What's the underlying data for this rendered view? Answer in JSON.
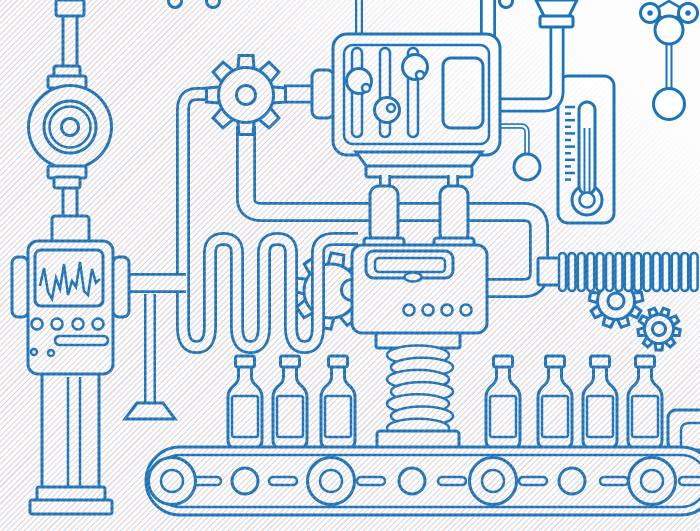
{
  "scene": {
    "width": 700,
    "height": 531,
    "description": "blue outline factory machine illustration"
  },
  "palette": {
    "stroke": "#1a74ba",
    "fill": "#ffffff",
    "hatch_warm": "rgba(198,141,141,0.40)",
    "hatch_cool": "rgba(141,160,198,0.38)"
  },
  "serpentine": {
    "start": "M246,94 H197 Q183,94 183,110 V327",
    "verticals": [
      183,
      210,
      237,
      264,
      291,
      318
    ],
    "bottom_y": 347,
    "top_y": 239,
    "v_top": 253,
    "v_bottom": 327,
    "end": "V253 Q318,239 334,239 H358",
    "width": 14,
    "inner_width": 8.5
  },
  "gears": [
    {
      "slot": "slot-gear-mid",
      "name": "gear-middle-icon",
      "cx": 331,
      "cy": 291,
      "body_r": 27,
      "hub_r": 0,
      "teeth": 8,
      "tooth_inner": 21,
      "tooth_outer": 37.5,
      "tooth_halfw": 8,
      "angle": -80
    },
    {
      "slot": "slot-gear-large",
      "name": "gear-large-icon",
      "cx": 246,
      "cy": 95,
      "body_r": 27.5,
      "hub_r": 9.5,
      "teeth": 8,
      "tooth_inner": 21,
      "tooth_outer": 39.5,
      "tooth_halfw": 8.5,
      "angle": -90
    },
    {
      "slot": "slot-gear-right1",
      "name": "gear-small-left-icon",
      "cx": 616,
      "cy": 301,
      "body_r": 18.5,
      "hub_r": 8,
      "teeth": 9,
      "tooth_inner": 13,
      "tooth_outer": 26.5,
      "tooth_halfw": 5.5,
      "angle": -90
    },
    {
      "slot": "slot-gear-right2",
      "name": "gear-small-right-icon",
      "cx": 659,
      "cy": 329,
      "body_r": 14.5,
      "hub_r": 6.5,
      "teeth": 9,
      "tooth_inner": 10,
      "tooth_outer": 21,
      "tooth_halfw": 4.5,
      "angle": -70
    }
  ],
  "hose": {
    "x0": 559,
    "step": 9.4,
    "count": 15,
    "y": 253,
    "rib_w": 7,
    "rib_h": 38,
    "rib_r": 3.5
  },
  "spring": {
    "cx_even": 418,
    "cx_odd": 422,
    "rx": 31,
    "ry": 9.5,
    "y0": 355,
    "dy": 12.2,
    "loops": 7
  },
  "thermometer": {
    "tick_x": 565,
    "tick_y0": 107,
    "tick_dy": 6.6,
    "tick_count": 12,
    "tick_long": 10,
    "tick_short": 6
  },
  "bottles": {
    "centers": [
      245,
      290,
      338,
      503,
      555,
      600,
      645
    ]
  },
  "conveyor": {
    "rollers_large": [
      172,
      331,
      493,
      652
    ],
    "rollers_small": [
      245,
      412,
      572
    ],
    "dashes": [
      207,
      283,
      371,
      452,
      533,
      614,
      693
    ]
  },
  "sliders": [
    {
      "cx": 357,
      "knob_y": 81,
      "dot_dx": 7,
      "dot_dy": 7
    },
    {
      "cx": 385,
      "knob_y": 110,
      "dot_dx": 4,
      "dot_dy": -2
    },
    {
      "cx": 413,
      "knob_y": 67,
      "dot_dx": 5,
      "dot_dy": 8
    }
  ],
  "machine": {
    "dots_x": [
      409,
      428,
      447,
      466
    ],
    "dots_y": 310
  },
  "robot": {
    "buttons_x": [
      37,
      57,
      78,
      98
    ],
    "buttons_y": 324,
    "waveform": "40,286 44,268 48,292 52,299 56,278 60,289 64,264 68,295 72,281 76,287 80,262 84,291 88,295 92,269 96,283 100,279"
  },
  "hanging_loops_x": [
    175,
    213,
    506
  ]
}
